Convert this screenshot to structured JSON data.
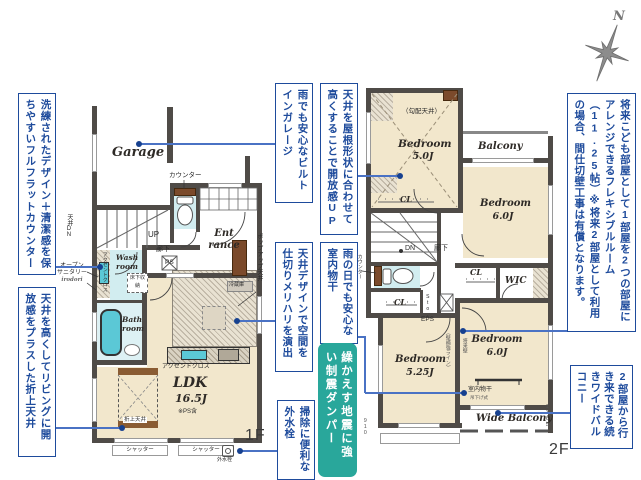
{
  "compass": {
    "north": "N"
  },
  "colors": {
    "note_blue": "#1e4b9c",
    "callout_blue": "#4a72c4",
    "damper_teal": "#29a79b",
    "floor_beige": "#f2e7cc",
    "wet_cyan": "#d2edf0",
    "tub_teal": "#5bc8d6",
    "wood_brown": "#7b4a2b",
    "wall_gray": "#4f4b47"
  },
  "notes": {
    "left_counter": "洗練されたデザイン＋清潔感を保ちやすいフルフラットカウンター",
    "left_ceiling": "天井を高くしてリビングに開放感をプラスした折上天井",
    "garage": "雨でも安心なビルトインガレージ",
    "roof": "天井を屋根形状に合わせて高くすることで開放感UP",
    "ceiling_design": "天井デザインで空間を仕切りメリハリを演出",
    "indoor_drying": "雨の日でも安心な室内物干",
    "faucet": "掃除に便利な外水栓",
    "damper": "繰かえす地震に強い制震ダンパー",
    "flexible_room": "将来こども部屋として1部屋を2つの部屋にアレンジできるフレキシブルルーム（11.25帖）※将来2部屋として利用の場合、間仕切壁工事は有償となります。",
    "wide_balcony": "2部屋から行き来できる続きワイドバルコニー"
  },
  "floor1": {
    "label": "1F",
    "garage": "Garage",
    "counter": "カウンター",
    "up": "UP",
    "hallway": "廊下",
    "ps": "PS",
    "entrance": "Ent rance",
    "wash_room": "Wash room",
    "bath_room": "Bath room",
    "ldk_name": "LDK",
    "ldk_size": "16.5J",
    "ldk_note": "※PS含",
    "accent_cloth_wall": "アクセントクロス",
    "accent_cloth_kitchen": "アクセントクロス",
    "ceiling_dn": "天井DN",
    "open_sanitary_line1": "オープン",
    "open_sanitary_line2": "サニタリー",
    "open_sanitary_brand": "irodori",
    "underfloor_storage": "床下収納",
    "popup_ceiling": "ポップアップ天井",
    "fridge": "冷蔵庫",
    "coffered_ceiling": "折上天井",
    "shutter_left": "シャッター",
    "shutter_right": "シャッター",
    "outdoor_faucet": "外水栓"
  },
  "floor2": {
    "label": "2F",
    "sloped_ceiling": "（勾配天井）",
    "bedroom_nw": {
      "name": "Bedroom",
      "size": "5.0J"
    },
    "balcony": "Balcony",
    "bedroom_ne": {
      "name": "Bedroom",
      "size": "6.0J"
    },
    "cl_north": "CL",
    "dn": "DN",
    "hallway": "廊下",
    "counter": "カウンター",
    "cl_west": "CL",
    "sto": "Sto.",
    "eps": "EPS",
    "cl_mid": "CL",
    "wic": "WIC",
    "bedroom_se": {
      "name": "Bedroom",
      "size": "6.0J"
    },
    "bedroom_sw": {
      "name": "Bedroom",
      "size": "5.25J"
    },
    "wall_line_note": "（壁補強ライン）",
    "future_wall_note": "将来壁",
    "indoor_drying": "室内物干",
    "drying_type": "吊下げ式",
    "wide_balcony": "Wide Balcony",
    "dim_left": "910",
    "dim_right": "1365"
  }
}
